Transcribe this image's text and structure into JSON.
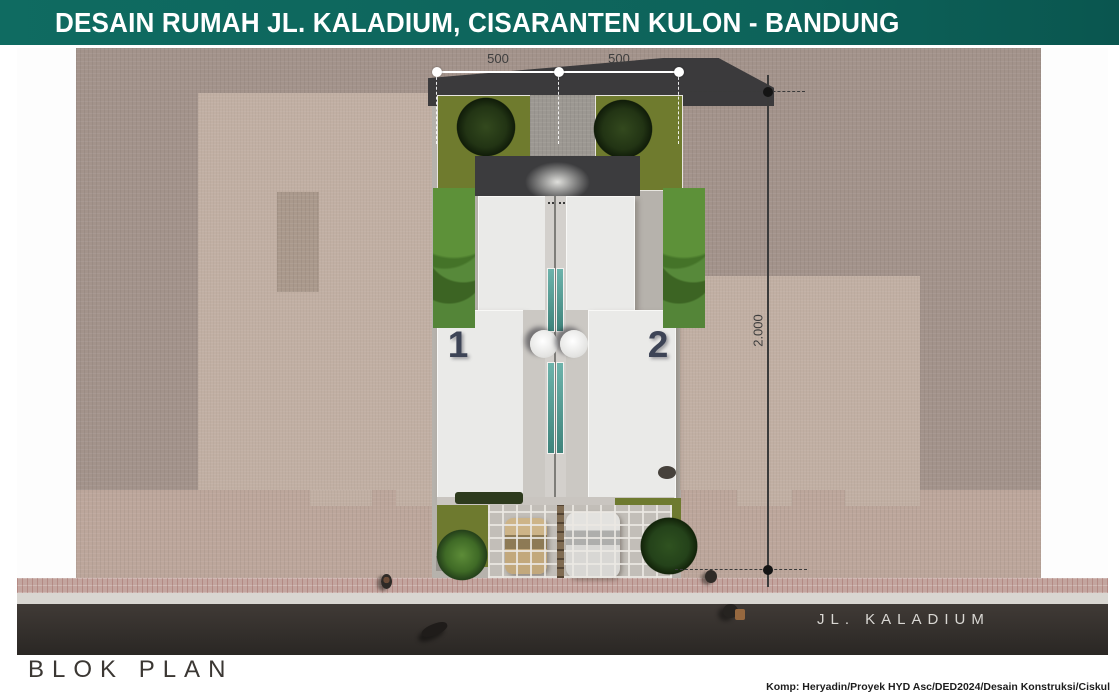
{
  "slide": {
    "title": "DESAIN RUMAH JL. KALADIUM, CISARANTEN KULON - BANDUNG",
    "footer_label": "BLOK PLAN",
    "credit": "Komp: Heryadin/Proyek HYD Asc/DED2024/Desain Konstruksi/Ciskul"
  },
  "plan": {
    "street_label": "JL. KALADIUM",
    "unit_labels": [
      "1",
      "2"
    ],
    "dimensions": {
      "top": [
        "500",
        "500"
      ],
      "right": "2.000"
    }
  },
  "colors": {
    "header_teal": "#0d635a",
    "paving_brown": "#a3938b",
    "front_paving_light": "#bca69b",
    "neighbor_roof_tan": "#c1afa3",
    "garden_olive": "#6f7b2e",
    "house_roof_white": "#eaeae8",
    "skylight_teal": "#5fa8a0",
    "road_dark": "#34302c",
    "sidewalk_pink": "#c3a59f",
    "unit_number_navy": "#3d4456",
    "dimension_gray": "#3e3e3e"
  }
}
